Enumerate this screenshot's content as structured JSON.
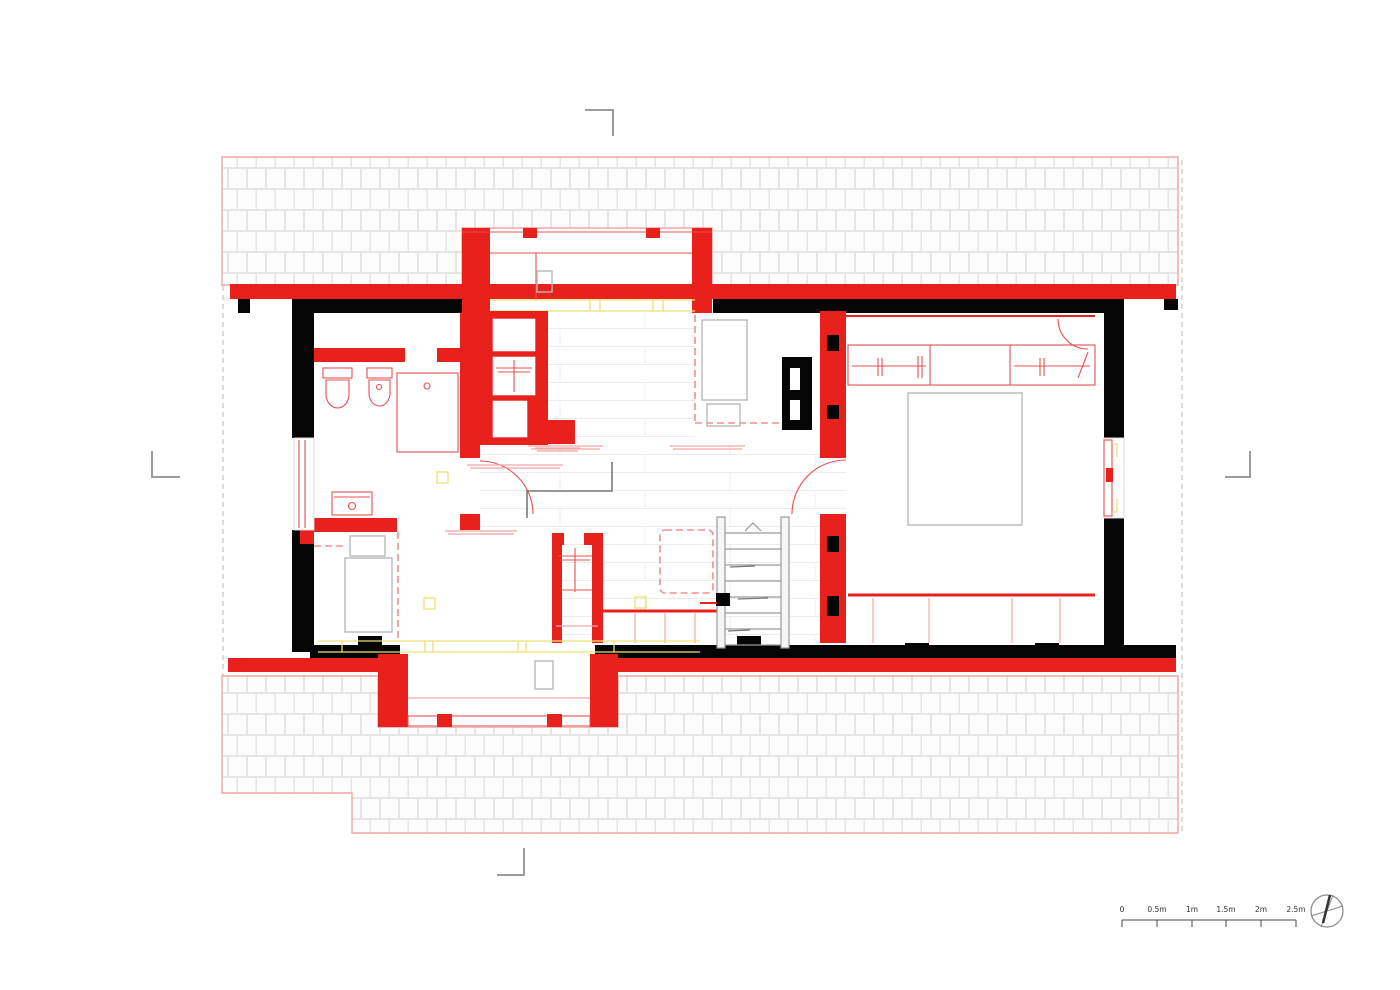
{
  "scale_bar": {
    "labels": [
      "0",
      "0.5m",
      "1m",
      "1.5m",
      "2m",
      "2.5m"
    ]
  },
  "compass": {
    "icon": "north-arrow-compass-icon"
  },
  "colors": {
    "new_wall_red": "#e8211c",
    "existing_wall_black": "#050505",
    "fixture_thin_red": "#e85050",
    "overhead_yellow": "#e9e276",
    "roof_outline_pink": "#f2a5a5",
    "furniture_gray": "#b9b9b9",
    "roof_tile_line": "#e5e5e5"
  }
}
